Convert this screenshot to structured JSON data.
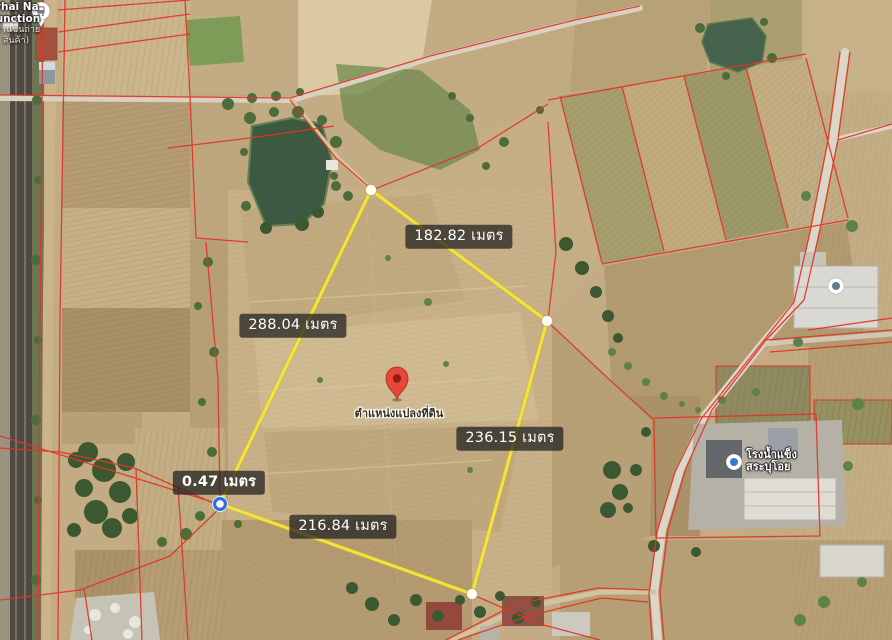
{
  "station": {
    "line1": "Phai Na",
    "line2": "Junction",
    "line3": "(ลานขนถ่าย",
    "line4": "สินค้า)"
  },
  "parcel": {
    "outline_color": "#f4e33b",
    "vertices": [
      [
        371,
        190
      ],
      [
        547,
        321
      ],
      [
        472,
        594
      ],
      [
        220,
        504
      ]
    ],
    "measurements": [
      {
        "text": "182.82 เมตร"
      },
      {
        "text": "288.04 เมตร"
      },
      {
        "text": "236.15 เมตร"
      },
      {
        "text": "216.84 เมตร"
      },
      {
        "text": "0.47 เมตร"
      }
    ]
  },
  "pin": {
    "label": "ตำแหน่งแปลงที่ดิน",
    "color": "#e9453b"
  },
  "poi": {
    "factory_line1": "โรงน้ำแข็ง",
    "factory_line2": "สระบุโอย"
  },
  "colors": {
    "cadastral_line": "#e03527",
    "selected_vertex": "#2e6fe8",
    "measure_label_bg": "rgba(32,32,32,0.74)"
  }
}
